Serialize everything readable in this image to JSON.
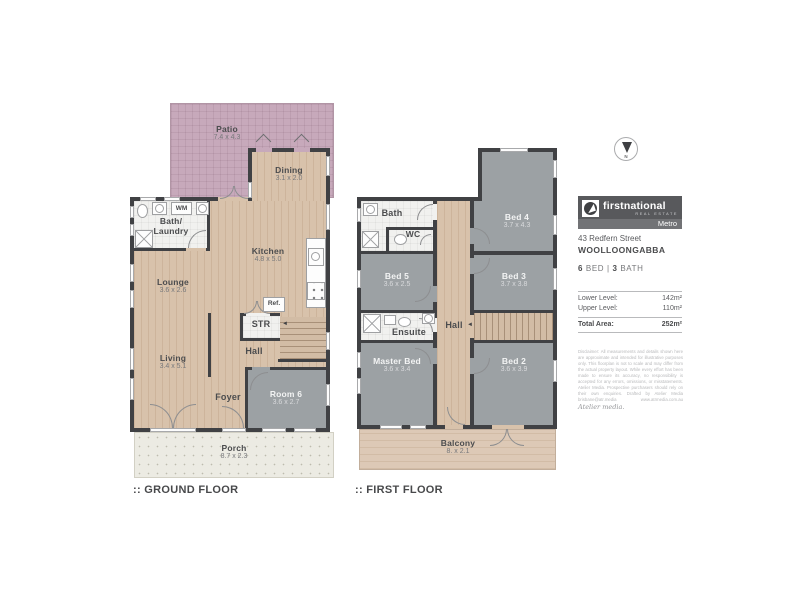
{
  "ground_floor": {
    "caption": ":: GROUND FLOOR",
    "stair_arrow": "◄",
    "rooms": {
      "patio": {
        "name": "Patio",
        "dims": "7.4 x 4.3"
      },
      "dining": {
        "name": "Dining",
        "dims": "3.1 x 2.0"
      },
      "bath_laundry": {
        "line1": "Bath/",
        "line2": "Laundry",
        "washing_machine": "WM"
      },
      "kitchen": {
        "name": "Kitchen",
        "dims": "4.8 x 5.0"
      },
      "lounge": {
        "name": "Lounge",
        "dims": "3.6 x 2.6"
      },
      "fridge": {
        "label": "Ref."
      },
      "storage": {
        "label": "STR"
      },
      "hall": {
        "label": "Hall"
      },
      "living": {
        "name": "Living",
        "dims": "3.4 x 5.1"
      },
      "foyer": {
        "label": "Foyer"
      },
      "room6": {
        "name": "Room 6",
        "dims": "3.6 x 2.7"
      },
      "porch": {
        "name": "Porch",
        "dims": "8.7 x 2.3"
      }
    }
  },
  "first_floor": {
    "caption": ":: FIRST FLOOR",
    "stair_arrow": "◄",
    "rooms": {
      "bath": {
        "label": "Bath"
      },
      "wc": {
        "label": "WC"
      },
      "bed4": {
        "name": "Bed 4",
        "dims": "3.7 x 4.3"
      },
      "bed5": {
        "name": "Bed 5",
        "dims": "3.6 x 2.5"
      },
      "bed3": {
        "name": "Bed 3",
        "dims": "3.7 x 3.8"
      },
      "ensuite": {
        "label": "Ensuite"
      },
      "hall": {
        "label": "Hall"
      },
      "master_bed": {
        "name": "Master Bed",
        "dims": "3.6 x 3.4"
      },
      "bed2": {
        "name": "Bed 2",
        "dims": "3.6 x 3.9"
      },
      "balcony": {
        "name": "Balcony",
        "dims": "8. x 2.1"
      }
    }
  },
  "sidebar": {
    "compass": {
      "north_label": "N"
    },
    "logo": {
      "brand": "firstnational",
      "tagline": "REAL ESTATE",
      "office": "Metro"
    },
    "address_line1": "43 Redfern Street",
    "address_line2": "WOOLLOONGABBA",
    "summary": {
      "beds_count": "6",
      "beds_label": "BED",
      "divider": "|",
      "baths_count": "3",
      "baths_label": "BATH"
    },
    "areas": {
      "rows": [
        {
          "label": "Lower Level:",
          "value": "142m²"
        },
        {
          "label": "Upper Level:",
          "value": "110m²"
        }
      ],
      "total_label": "Total Area:",
      "total_value": "252m²"
    },
    "disclaimer": "Disclaimer: All measurements and details shown here are approximate and intended for illustrative purposes only. This floorplan is not to scale and may differ from the actual property layout. While every effort has been made to ensure its accuracy, no responsibility is accepted for any errors, omissions, or misstatements. Atelier Media. Prospective purchasers should rely on their own enquiries. Drafted by Atelier Media brisbane@atr.media www.atrmedia.com.au",
    "media_brand": "Atelier media."
  },
  "colors": {
    "wall": "#404144",
    "wood_floor": "#d8c2ab",
    "gray_room": "#9ca1a4",
    "patio": "#c7a9bb",
    "white_room": "#f1f1ef",
    "porch": "#ecebe3",
    "balcony": "#ddc9b6",
    "logo_bg": "#58595c",
    "text_dark": "#4b4c4e"
  }
}
